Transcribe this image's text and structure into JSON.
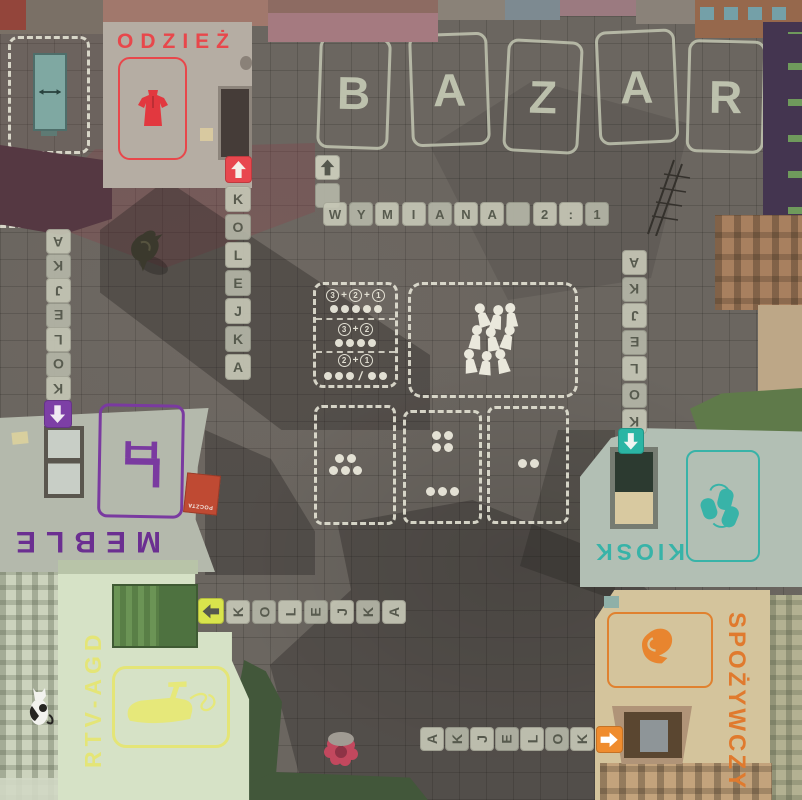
{
  "board": {
    "bazar_letters": [
      "B",
      "A",
      "Z",
      "A",
      "R"
    ],
    "exchange_word_tiles": [
      "W",
      "Y",
      "M",
      "I",
      "A",
      "N",
      "A"
    ],
    "exchange_rate_tiles": [
      "2",
      ":",
      "1"
    ],
    "queue_word": "KOLEJKA"
  },
  "queues": {
    "odziez_column": [
      "K",
      "O",
      "L",
      "E",
      "J",
      "K",
      "A"
    ],
    "left_column": [
      "A",
      "K",
      "J",
      "E",
      "L",
      "O",
      "K"
    ],
    "right_column": [
      "A",
      "K",
      "J",
      "E",
      "L",
      "O",
      "K"
    ],
    "rtv_row": [
      "K",
      "O",
      "L",
      "E",
      "J",
      "K",
      "A"
    ],
    "spozywczy_row": [
      "A",
      "K",
      "J",
      "E",
      "L",
      "O",
      "K"
    ]
  },
  "shops": {
    "odziez": {
      "name": "ODZIEŻ",
      "accent": "#e8474b",
      "icon": "dress-icon"
    },
    "meble": {
      "name": "MEBLE",
      "accent": "#6b2f91",
      "icon": "chair-icon"
    },
    "rtv_agd": {
      "name": "RTV-AGD",
      "accent": "#e6e87a",
      "icon": "iron-icon"
    },
    "kiosk": {
      "name": "KIOSK",
      "accent": "#38b3a8",
      "icon": "newspapers-icon"
    },
    "spozywczy": {
      "name": "SPOŻYWCZY",
      "accent": "#e0812f",
      "icon": "chicken-icon"
    },
    "poczta": {
      "name": "POCZTA",
      "accent": "#bf4a33"
    }
  },
  "exchange_panel": {
    "rows": [
      {
        "numbers": [
          "3",
          "2",
          "1"
        ],
        "pip_groups": [
          5
        ]
      },
      {
        "numbers": [
          "3",
          "2"
        ],
        "pip_groups": [
          4
        ]
      },
      {
        "numbers": [
          "2",
          "1"
        ],
        "pip_groups": [
          3,
          2
        ]
      }
    ]
  },
  "dice_boxes": [
    {
      "clusters": [
        [
          2,
          3
        ]
      ]
    },
    {
      "clusters": [
        [
          2,
          2
        ],
        [
          3
        ]
      ]
    },
    {
      "clusters": [
        [
          2
        ]
      ]
    }
  ],
  "arrows": {
    "odziez": {
      "dir": "up",
      "tile": "#e8474e",
      "glyph": "#f5efe8"
    },
    "bazar_entry": {
      "dir": "up",
      "tile": "#c6c7b6",
      "glyph": "#55584e"
    },
    "meble": {
      "dir": "down",
      "tile": "#7d3fa6",
      "glyph": "#f0eaf2"
    },
    "rtv_agd": {
      "dir": "left",
      "tile": "#d9e44c",
      "glyph": "#55584e"
    },
    "kiosk": {
      "dir": "down",
      "tile": "#2bb5a4",
      "glyph": "#f0f5f2"
    },
    "spozywczy": {
      "dir": "right",
      "tile": "#ef8c2e",
      "glyph": "#ffffff"
    }
  },
  "figures": [
    "queue-people-icon",
    "wardrobe-icon",
    "pigeon-icon",
    "cat-icon",
    "flowers-icon"
  ]
}
